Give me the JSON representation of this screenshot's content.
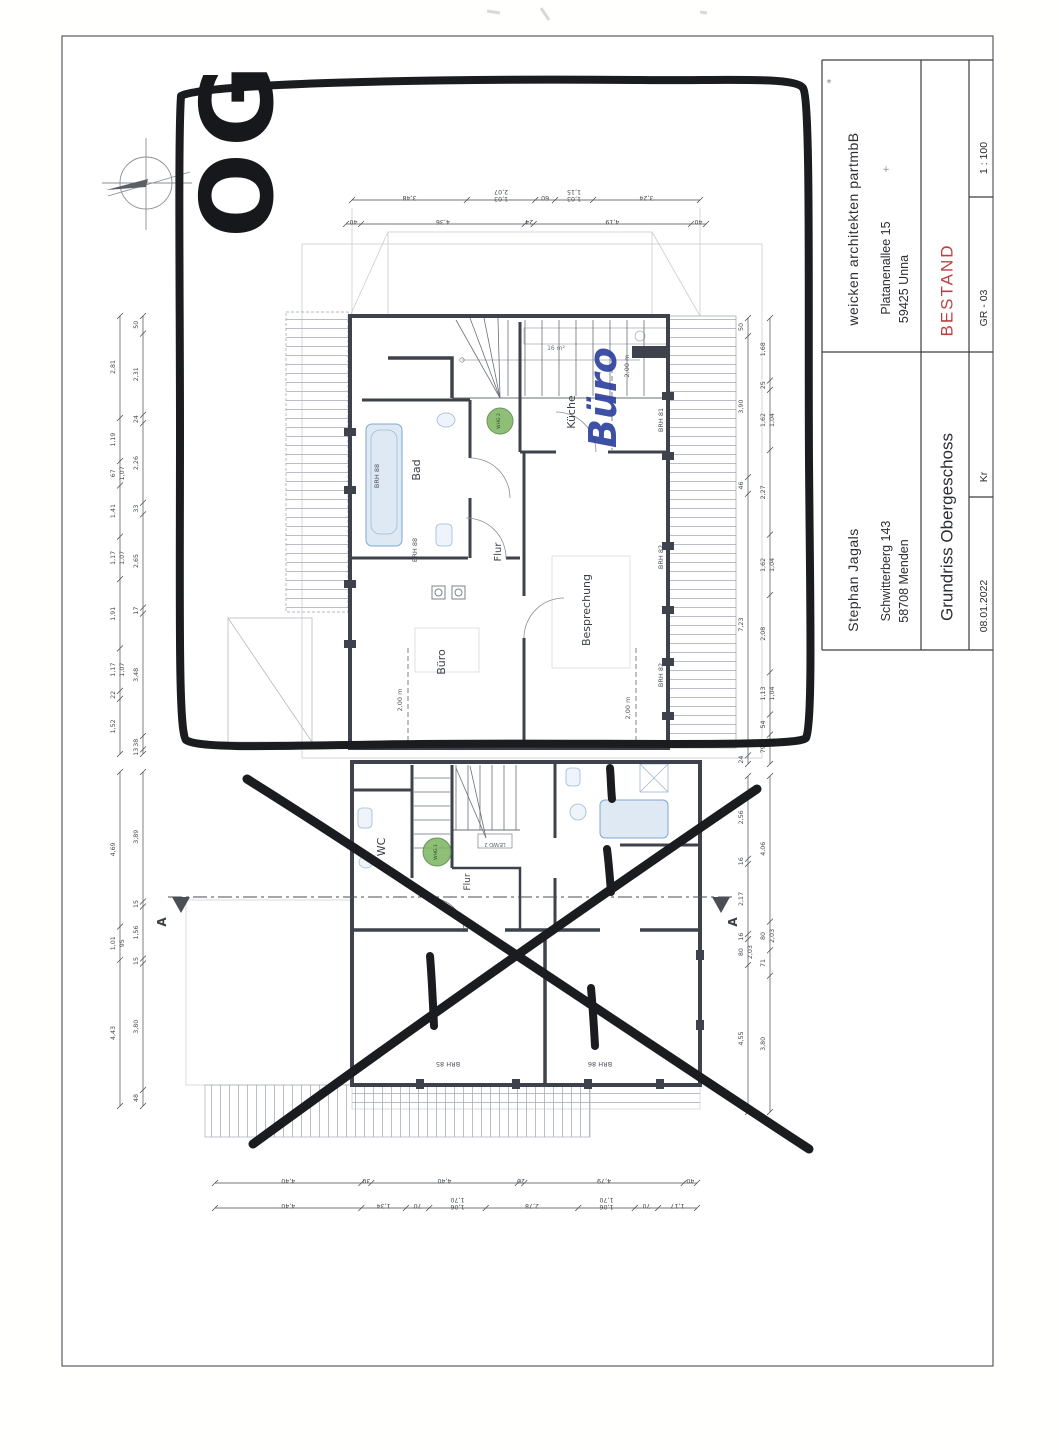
{
  "title_block": {
    "architect": {
      "name": "weicken architekten partmbB",
      "street": "Platanenallee 15",
      "city": "59425 Unna"
    },
    "client": {
      "name": "Stephan Jagals",
      "street": "Schwitterberg 143",
      "city": "58708 Menden"
    },
    "status_label": "BESTAND",
    "drawing_title": "Grundriss Obergeschoss",
    "scale": "1 : 100",
    "sheet_number": "GR - 03",
    "author_initials": "Kr",
    "date": "08.01.2022"
  },
  "hand_annotations": {
    "floor_label": "OG",
    "room_relabel": "Büro"
  },
  "colors": {
    "ink": "#3a3f47",
    "dim": "#44494f",
    "wall": "#3d424c",
    "faint": "#c9cdd3",
    "hatch": "#a7adb6",
    "fixture": "#7fa8cf",
    "status_red": "#bf4040",
    "hand_black": "#1b1c20",
    "hand_blue": "#2b3f9e",
    "whg_green": "#7cb560"
  },
  "plan_labels": [
    {
      "t": "Küche",
      "x": 575,
      "y": 412,
      "r": -90,
      "s": 11,
      "n": "room-label-kueche"
    },
    {
      "t": "16 m²",
      "x": 556,
      "y": 350,
      "r": 0,
      "s": 6,
      "c": "#6a7078",
      "n": "area-label"
    },
    {
      "t": "Bad",
      "x": 420,
      "y": 470,
      "r": -90,
      "s": 11,
      "n": "room-label-bad"
    },
    {
      "t": "Flur",
      "x": 501,
      "y": 552,
      "r": -90,
      "s": 10,
      "n": "room-label-flur-og"
    },
    {
      "t": "Büro",
      "x": 445,
      "y": 662,
      "r": -90,
      "s": 11,
      "n": "room-label-buero"
    },
    {
      "t": "Besprechung",
      "x": 590,
      "y": 610,
      "r": -90,
      "s": 11,
      "n": "room-label-besprechung"
    },
    {
      "t": "BRH 88",
      "x": 379,
      "y": 476,
      "r": -90,
      "s": 6.5,
      "c": "#4a505a",
      "n": "sill-label"
    },
    {
      "t": "BRH 88",
      "x": 417,
      "y": 550,
      "r": -90,
      "s": 6.5,
      "c": "#4a505a",
      "n": "sill-label"
    },
    {
      "t": "BRH 81",
      "x": 663,
      "y": 420,
      "r": -90,
      "s": 6.5,
      "c": "#4a505a",
      "n": "sill-label"
    },
    {
      "t": "BRH 82",
      "x": 663,
      "y": 557,
      "r": -90,
      "s": 6.5,
      "c": "#4a505a",
      "n": "sill-label"
    },
    {
      "t": "BRH 82",
      "x": 663,
      "y": 675,
      "r": -90,
      "s": 6.5,
      "c": "#4a505a",
      "n": "sill-label"
    },
    {
      "t": "2,00 m",
      "x": 629,
      "y": 366,
      "r": -90,
      "s": 6.5,
      "c": "#5a6068",
      "n": "height-line-label"
    },
    {
      "t": "2,00 m",
      "x": 402,
      "y": 700,
      "r": -90,
      "s": 6.5,
      "c": "#5a6068",
      "n": "height-line-label"
    },
    {
      "t": "2,00 m",
      "x": 630,
      "y": 708,
      "r": -90,
      "s": 6.5,
      "c": "#5a6068",
      "n": "height-line-label"
    },
    {
      "t": "WC",
      "x": 385,
      "y": 847,
      "r": -90,
      "s": 11,
      "n": "room-label-wc"
    },
    {
      "t": "Flur",
      "x": 470,
      "y": 882,
      "r": -90,
      "s": 9,
      "n": "room-label-flur-lower"
    },
    {
      "t": "LE/WD 2",
      "x": 495,
      "y": 843,
      "r": 180,
      "s": 5,
      "c": "#555b62",
      "n": "fixture-label"
    },
    {
      "t": "BRH 85",
      "x": 448,
      "y": 1062,
      "r": 180,
      "s": 6.5,
      "c": "#4a505a",
      "n": "sill-label"
    },
    {
      "t": "BRH 86",
      "x": 600,
      "y": 1062,
      "r": 180,
      "s": 6.5,
      "c": "#4a505a",
      "n": "sill-label"
    },
    {
      "t": "A",
      "x": 166,
      "y": 922,
      "r": -90,
      "s": 12,
      "b": 1,
      "n": "section-marker-a-left"
    },
    {
      "t": "A",
      "x": 737,
      "y": 922,
      "r": -90,
      "s": 12,
      "b": 1,
      "n": "section-marker-a-right"
    },
    {
      "t": "WHG 2",
      "x": 500,
      "y": 421,
      "r": -90,
      "s": 4.5,
      "c": "#24501f",
      "n": "whg-marker-label"
    },
    {
      "t": "WHG 1",
      "x": 437,
      "y": 852,
      "r": -90,
      "s": 4.5,
      "c": "#24501f",
      "n": "whg-marker-label"
    },
    {
      "t": "*",
      "x": 829,
      "y": 86,
      "r": 0,
      "s": 10,
      "c": "#7d828a",
      "n": "hand-mark"
    },
    {
      "t": "+",
      "x": 886,
      "y": 172,
      "r": 0,
      "s": 9,
      "c": "#8a8f96",
      "n": "hand-mark"
    }
  ],
  "dimension_chains": [
    {
      "name": "top-fine",
      "dir": "h",
      "x": 352,
      "y": 200,
      "len": 348,
      "values": [
        "3,48",
        "2,07|1,03",
        "60",
        "1,15|1,03",
        "3,24"
      ]
    },
    {
      "name": "top-coarse",
      "dir": "h",
      "x": 346,
      "y": 224,
      "len": 360,
      "values": [
        "40",
        "4,36",
        "24",
        "4,19",
        "40"
      ]
    },
    {
      "name": "upper-left-fine",
      "dir": "v",
      "x": 120,
      "y": 316,
      "len": 438,
      "values": [
        "2,81",
        "1,19",
        "67|1,07",
        "1,41",
        "1,17|1,07",
        "1,91",
        "1,17|1,07",
        "22",
        "1,52"
      ]
    },
    {
      "name": "upper-left-coarse",
      "dir": "v",
      "x": 143,
      "y": 316,
      "len": 438,
      "values": [
        "50",
        "2,31",
        "24",
        "2,26",
        "33",
        "2,65",
        "17",
        "3,48",
        "38",
        "13"
      ]
    },
    {
      "name": "upper-right-coarse",
      "dir": "v",
      "x": 748,
      "y": 318,
      "len": 446,
      "values": [
        "50",
        "3,90",
        "46",
        "7,23",
        "24"
      ]
    },
    {
      "name": "upper-right-fine",
      "dir": "v",
      "x": 770,
      "y": 318,
      "len": 446,
      "values": [
        "1,68",
        "25",
        "1,62|1,04",
        "2,27",
        "1,62|1,04",
        "2,08",
        "1,13|1,04",
        "54",
        "79"
      ]
    },
    {
      "name": "bottom-coarse",
      "dir": "h",
      "x": 215,
      "y": 1183,
      "len": 482,
      "values": [
        "4,40",
        "30",
        "4,40",
        "20",
        "4,79",
        "40"
      ]
    },
    {
      "name": "bottom-fine",
      "dir": "h",
      "x": 215,
      "y": 1208,
      "len": 482,
      "values": [
        "4,40",
        "1,34",
        "70",
        "1,70|1,06",
        "2,78",
        "1,70|1,06",
        "70",
        "1,17"
      ]
    },
    {
      "name": "lower-left-coarse",
      "dir": "v",
      "x": 120,
      "y": 772,
      "len": 334,
      "values": [
        "4,69",
        "1,01|95",
        "4,43"
      ]
    },
    {
      "name": "lower-left-fine",
      "dir": "v",
      "x": 143,
      "y": 772,
      "len": 334,
      "values": [
        "3,89",
        "15",
        "1,56",
        "15",
        "3,80",
        "48"
      ]
    },
    {
      "name": "lower-right-coarse",
      "dir": "v",
      "x": 748,
      "y": 776,
      "len": 336,
      "values": [
        "2,56",
        "16",
        "2,17",
        "16",
        "80|2,03",
        "4,55"
      ]
    },
    {
      "name": "lower-right-fine",
      "dir": "v",
      "x": 770,
      "y": 776,
      "len": 336,
      "values": [
        "4,06",
        "80|2,03",
        "71",
        "3,80"
      ]
    }
  ]
}
